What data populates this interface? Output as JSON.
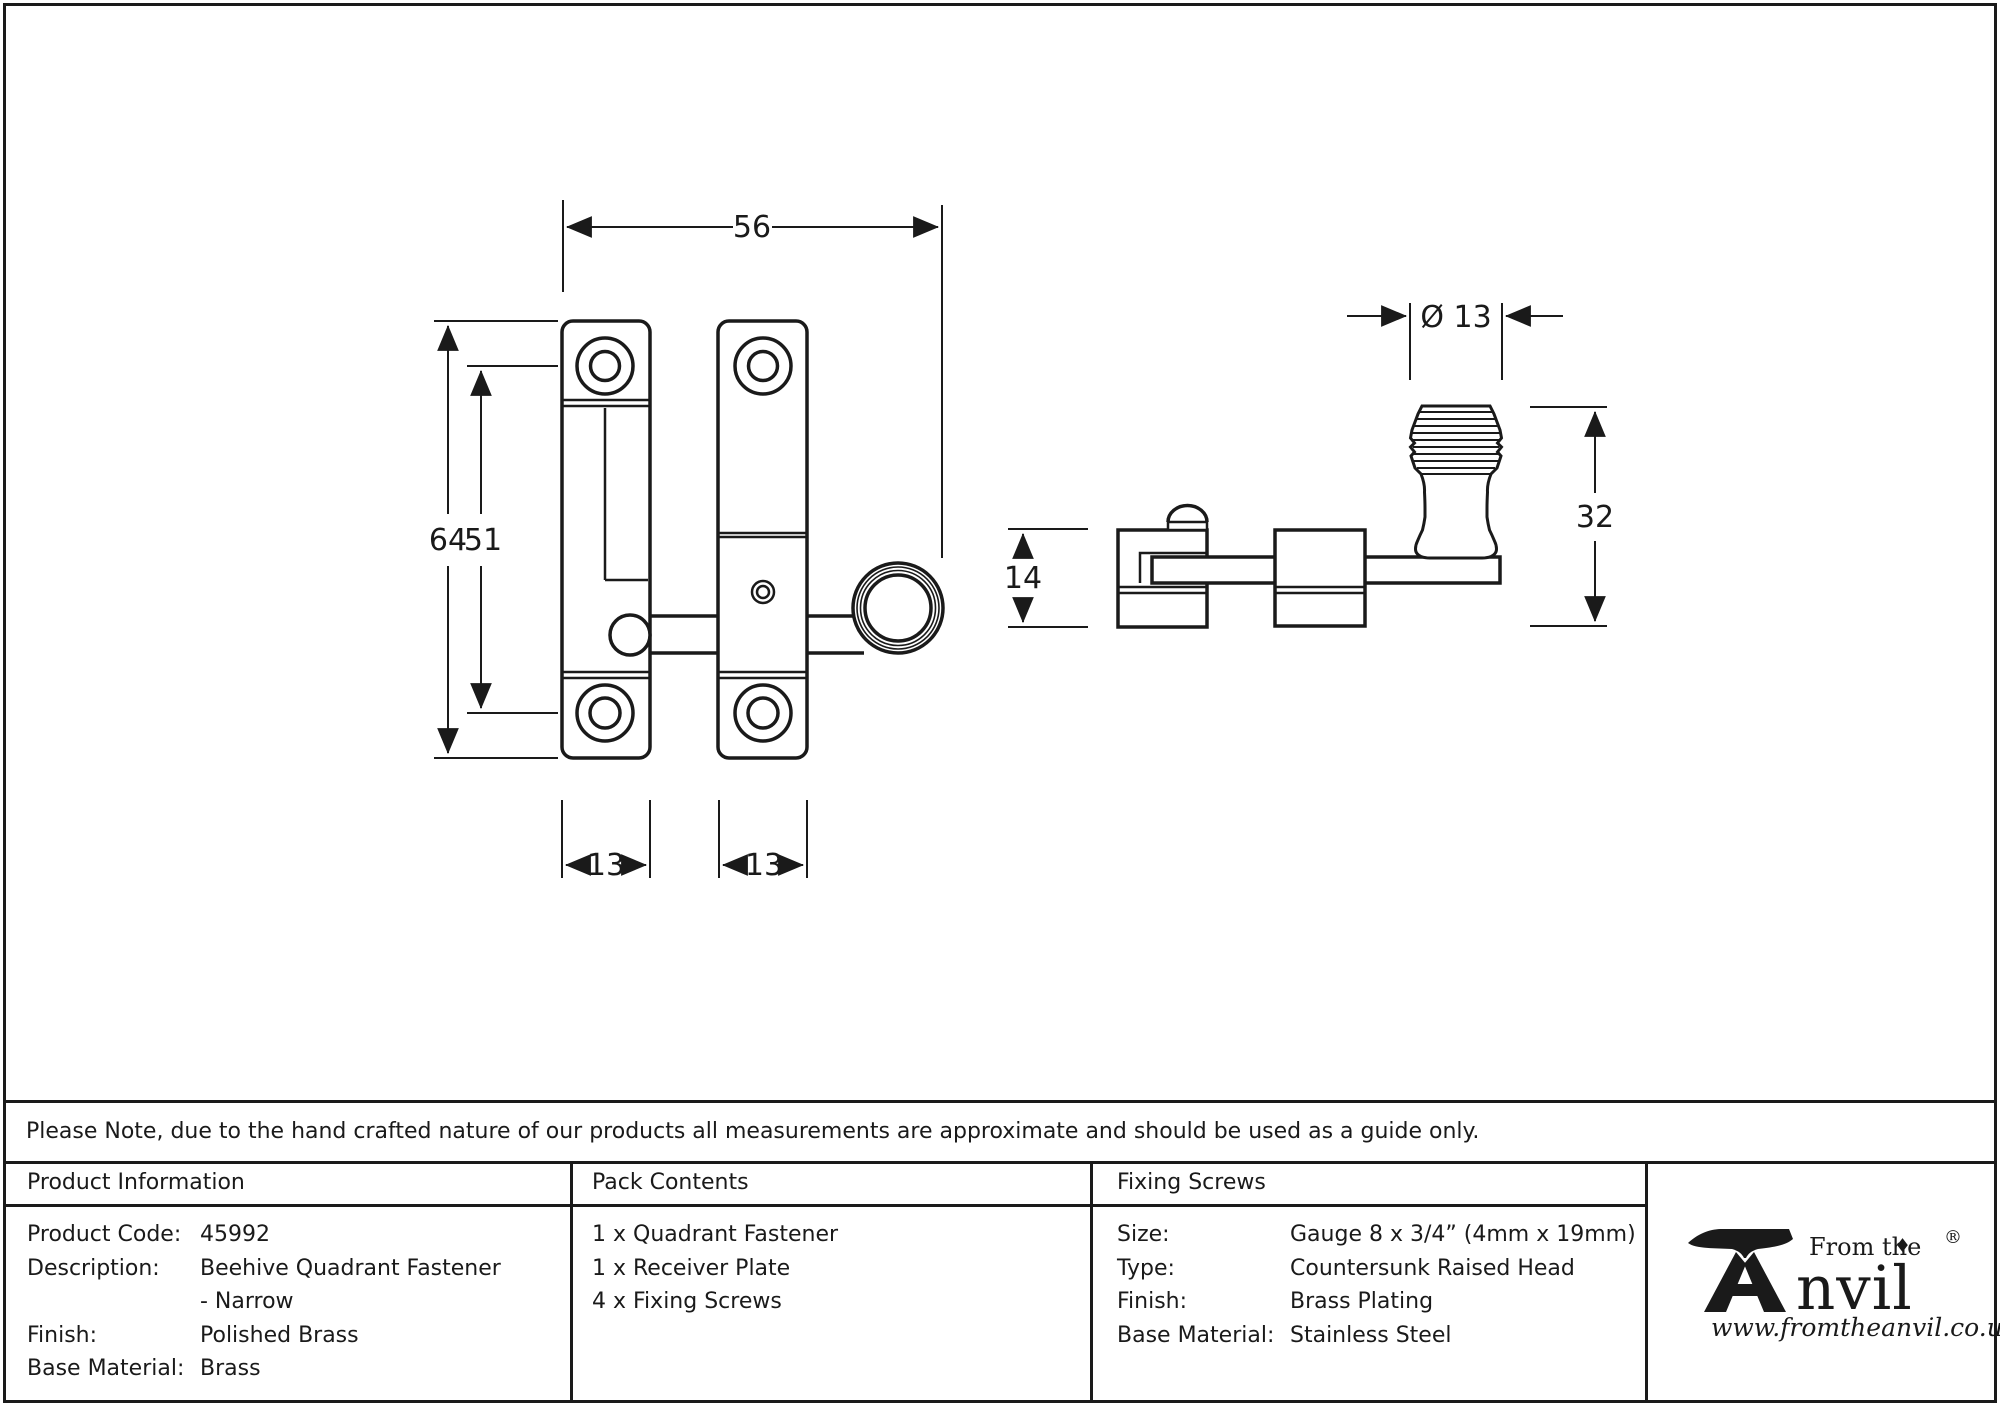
{
  "note": "Please Note, due to the hand crafted nature of our products all measurements are approximate and should be used as a guide only.",
  "drawing": {
    "front_view": {
      "dim_width": "56",
      "dim_height_overall": "64",
      "dim_height_centers": "51",
      "dim_plate_left_width": "13",
      "dim_plate_right_width": "13"
    },
    "side_view": {
      "dim_knob_diameter": "Ø 13",
      "dim_knob_height": "32",
      "dim_bracket_height": "14"
    }
  },
  "product_information": {
    "header": "Product Information",
    "rows": [
      {
        "label": "Product Code:",
        "value": "45992"
      },
      {
        "label": "Description:",
        "value": "Beehive Quadrant Fastener"
      },
      {
        "label": "",
        "value": "- Narrow"
      },
      {
        "label": "Finish:",
        "value": "Polished Brass"
      },
      {
        "label": "Base Material:",
        "value": "Brass"
      }
    ]
  },
  "pack_contents": {
    "header": "Pack Contents",
    "items": [
      "1 x Quadrant Fastener",
      "1 x Receiver Plate",
      "4 x Fixing Screws"
    ]
  },
  "fixing_screws": {
    "header": "Fixing Screws",
    "rows": [
      {
        "label": "Size:",
        "value": "Gauge 8 x 3/4” (4mm x 19mm)"
      },
      {
        "label": "Type:",
        "value": "Countersunk Raised Head"
      },
      {
        "label": "Finish:",
        "value": "Brass Plating"
      },
      {
        "label": "Base Material:",
        "value": "Stainless Steel"
      }
    ]
  },
  "logo": {
    "prefix": "From the",
    "diamond": "♦",
    "brand_suffix": "nvil",
    "registered": "®",
    "url": "www.fromtheanvil.co.uk"
  },
  "colors": {
    "ink": "#1a1a1a",
    "background": "#ffffff"
  }
}
